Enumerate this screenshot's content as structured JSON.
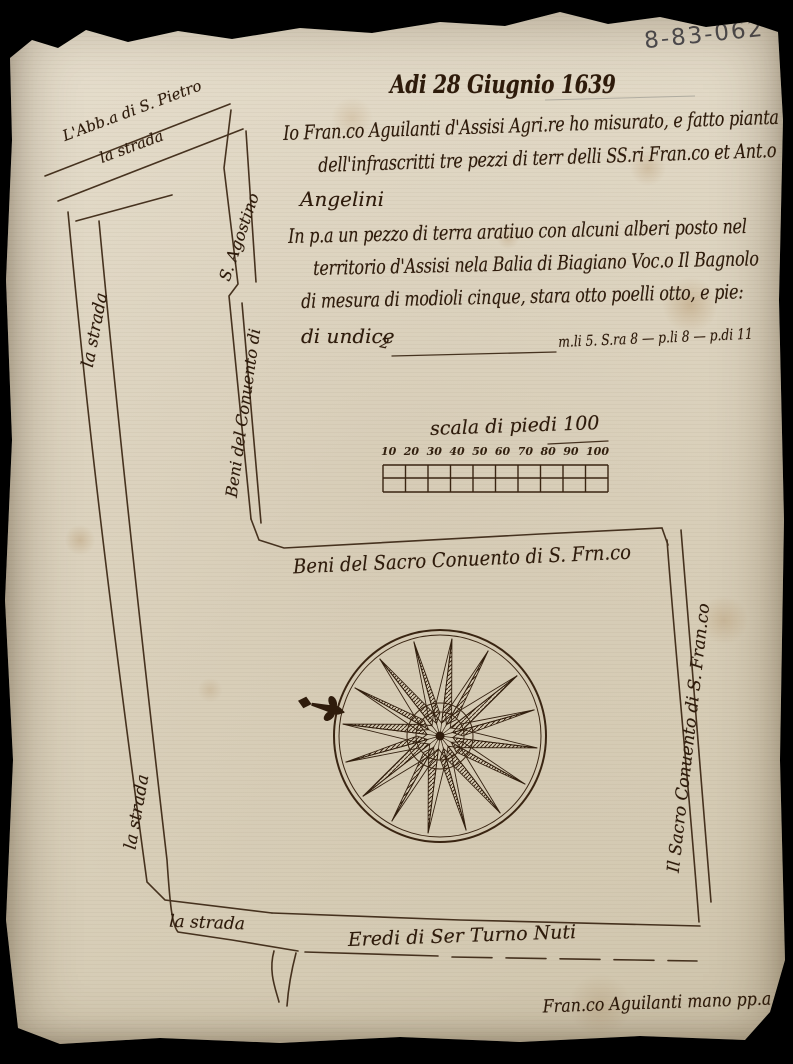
{
  "document": {
    "catalog_number": "8-83-062",
    "date_heading": "Adi 28 Giugnio 1639",
    "intro": {
      "line1": "Io Fran.co Aguilanti d'Assisi Agri.re ho misurato, e fatto pianta",
      "line2": "dell'infrascritti tre pezzi di terr delli SS.ri Fran.co et Ant.o",
      "line3": "Angelini"
    },
    "parcel_description": {
      "line1": "In p.a un pezzo di terra aratiuo con alcuni alberi posto nel",
      "line2": "territorio d'Assisi nela Balia di Biagiano Voc.o Il Bagnolo",
      "line3": "di mesura di modioli cinque, stara otto poelli otto, e pie:",
      "line4": "di undice",
      "leader_mark": "2",
      "measurement": "m.li 5. S.ra 8 — p.li 8 — p.di 11"
    },
    "signature": "Fran.co Aguilanti mano pp.a"
  },
  "scale": {
    "label": "scala di piedi 100",
    "ticks": [
      "10",
      "20",
      "30",
      "40",
      "50",
      "60",
      "70",
      "80",
      "90",
      "100"
    ]
  },
  "map_labels": {
    "abbey": "L'Abb.a di S. Pietro",
    "road_top": "la strada",
    "road_left_upper": "la strada",
    "road_left_lower": "la strada",
    "road_bottom": "la strada",
    "agostino_name": "S. Agostino",
    "agostino_prefix": "Beni del Conuento di",
    "boundary_top": "Beni del Sacro Conuento di S. Frn.co",
    "boundary_right": "Il Sacro Conuento di S. Fran.co",
    "boundary_bottom": "Eredi di Ser Turno Nuti"
  },
  "compass": {
    "points": 16,
    "marker": "fleur-de-lis"
  },
  "colors": {
    "ink": "#33200f",
    "paper": "#ddd4c0",
    "pencil": "#4d4c50",
    "background": "#000000"
  }
}
